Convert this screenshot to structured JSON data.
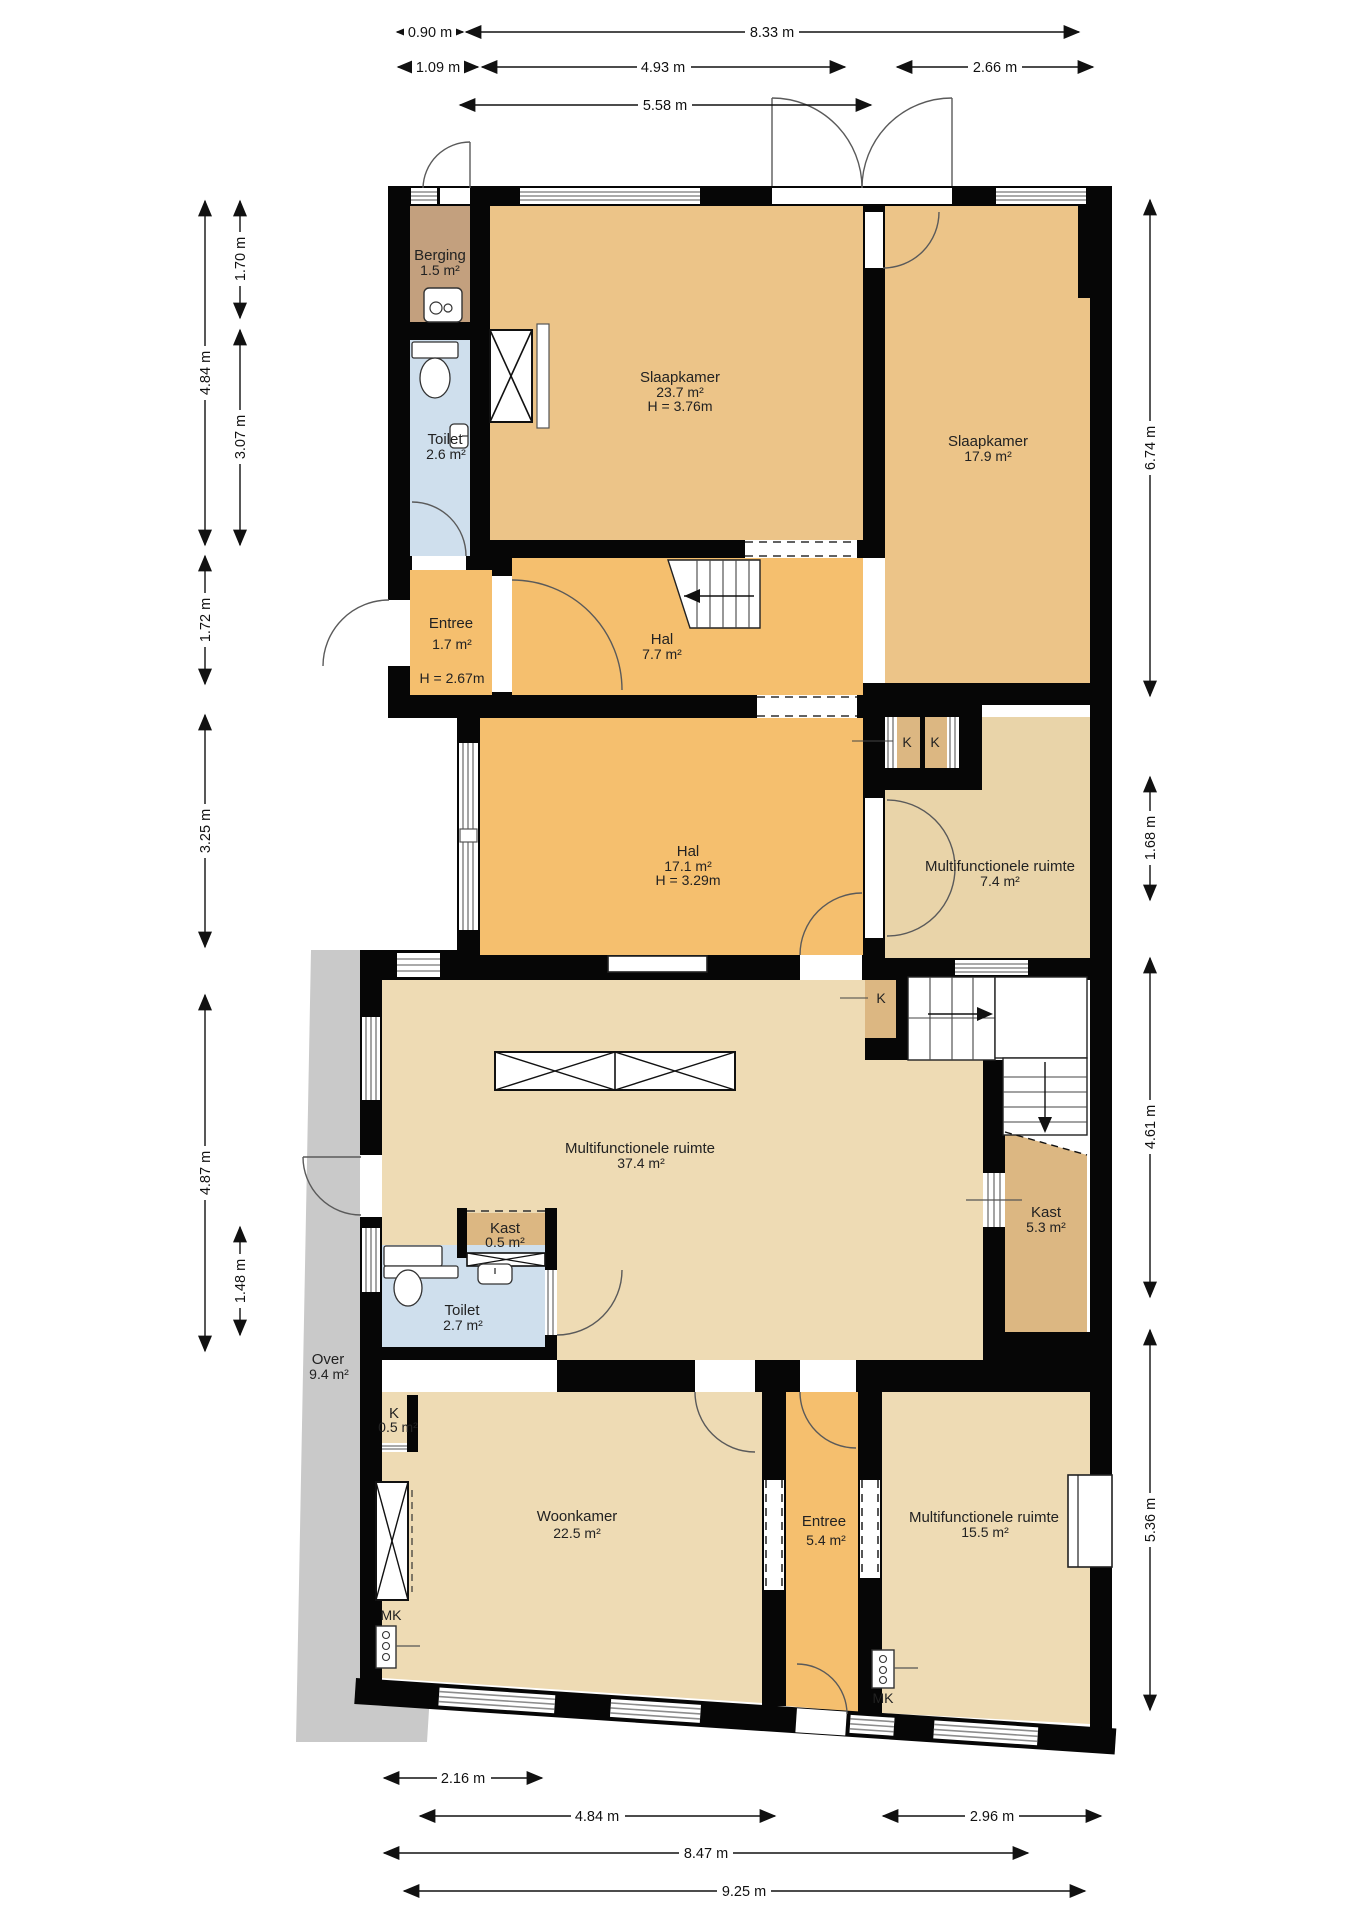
{
  "title": "Floor plan with dimensions",
  "colors": {
    "wall": "#060606",
    "room_orange": "#f5bf6e",
    "room_tan": "#ecc488",
    "room_beige": "#eedbb4",
    "room_beige_dark": "#e9d4a9",
    "closet_tan": "#dcb782",
    "berging_brown": "#c3a07e",
    "toilet_blue": "#cfdfed",
    "over_gray": "#c9c9c9"
  },
  "rooms": {
    "berging": {
      "name": "Berging",
      "area": "1.5 m²"
    },
    "toilet_boven": {
      "name": "Toilet",
      "area": "2.6 m²"
    },
    "slaapkamer_groot": {
      "name": "Slaapkamer",
      "area": "23.7 m²",
      "height": "H = 3.76m"
    },
    "slaapkamer_klein": {
      "name": "Slaapkamer",
      "area": "17.9 m²"
    },
    "entree_boven": {
      "name": "Entree",
      "area": "1.7 m²",
      "height": "H = 2.67m"
    },
    "hal_boven": {
      "name": "Hal",
      "area": "7.7 m²"
    },
    "hal_midden": {
      "name": "Hal",
      "area": "17.1 m²",
      "height": "H = 3.29m"
    },
    "multifunctioneel_klein": {
      "name": "Multifunctionele ruimte",
      "area": "7.4 m²"
    },
    "multifunctioneel_groot": {
      "name": "Multifunctionele ruimte",
      "area": "37.4 m²"
    },
    "kast_trap": {
      "name": "Kast",
      "area": "5.3 m²"
    },
    "kast_klein": {
      "name": "Kast",
      "area": "0.5 m²"
    },
    "toilet_beneden": {
      "name": "Toilet",
      "area": "2.7 m²"
    },
    "over": {
      "name": "Over",
      "area": "9.4 m²"
    },
    "k_klein": {
      "name": "K",
      "area": "0.5 m²"
    },
    "woonkamer": {
      "name": "Woonkamer",
      "area": "22.5 m²"
    },
    "entree_beneden": {
      "name": "Entree",
      "area": "5.4 m²"
    },
    "multifunctioneel_onder": {
      "name": "Multifunctionele ruimte",
      "area": "15.5 m²"
    }
  },
  "closets": {
    "k1": "K",
    "k2": "K",
    "k3": "K",
    "mk1": "MK",
    "mk2": "MK"
  },
  "dims": {
    "t_090": "0.90 m",
    "t_833": "8.33 m",
    "t_109": "1.09 m",
    "t_493": "4.93 m",
    "t_266": "2.66 m",
    "t_558": "5.58 m",
    "l_170": "1.70 m",
    "l_484": "4.84 m",
    "l_307": "3.07 m",
    "l_172": "1.72 m",
    "l_325": "3.25 m",
    "l_487": "4.87 m",
    "l_148": "1.48 m",
    "r_674": "6.74 m",
    "r_168": "1.68 m",
    "r_461": "4.61 m",
    "r_536": "5.36 m",
    "b_216": "2.16 m",
    "b_484": "4.84 m",
    "b_296": "2.96 m",
    "b_847": "8.47 m",
    "b_925": "9.25 m"
  }
}
